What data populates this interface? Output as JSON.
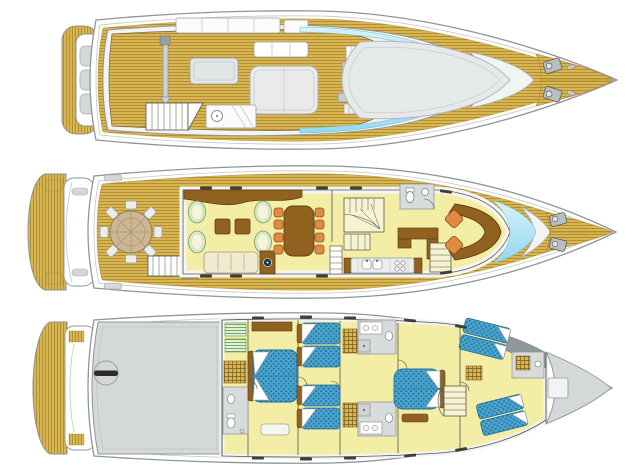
{
  "diagram": {
    "type": "yacht-deck-plan",
    "views": [
      {
        "name": "flybridge sun deck top view",
        "features": [
          "swim-platform",
          "transom-lockers",
          "crane-mast",
          "sun-lounger",
          "flybridge-table",
          "wet-bar",
          "stairs",
          "helm-station",
          "windscreen-glass",
          "foredeck-sunpad",
          "anchor-windlasses"
        ]
      },
      {
        "name": "main deck top view",
        "features": [
          "swim-platform",
          "aft-cockpit-round-table",
          "cockpit-chairs",
          "salon-armchairs",
          "coffee-tables",
          "sofa",
          "tv-cabinet",
          "dining-table",
          "dining-chairs",
          "spiral-staircase",
          "day-head",
          "galley-counter",
          "stairs-down",
          "helm-console",
          "helm-seats",
          "windshield-glass",
          "foredeck-windlasses"
        ]
      },
      {
        "name": "lower deck top view",
        "features": [
          "swim-platform",
          "engine-room",
          "engine-hatch",
          "guest-double-cabin",
          "twin-cabins",
          "vip-cabin",
          "bathrooms",
          "wardrobes",
          "staircase",
          "crew-bunks",
          "crew-bathroom",
          "bow-locker"
        ]
      }
    ]
  },
  "colors": {
    "background": "#ffffff",
    "hull_grey": "#8f9696",
    "hull_light": "#c3c7c7",
    "deck_grey": "#d5d8d8",
    "structure_white": "#f2f4f4",
    "teak": "#d9b552",
    "teak_line": "#a8872f",
    "floor_cream": "#f3eda6",
    "outline_dark": "#56564a",
    "wood_brown": "#91611f",
    "wood_dark": "#5e3f12",
    "seat_orange": "#e08a42",
    "sofa_cream": "#f1ead0",
    "chair_green": "#d6e8c4",
    "bed_blue": "#4aa3cd",
    "bed_blue_dark": "#1f6e96",
    "glass_blue": "#8fd8f0",
    "glass_blue_light": "#d8f3fb",
    "stair_cream": "#f6f2d2",
    "locker_green": "#dff2d8"
  }
}
